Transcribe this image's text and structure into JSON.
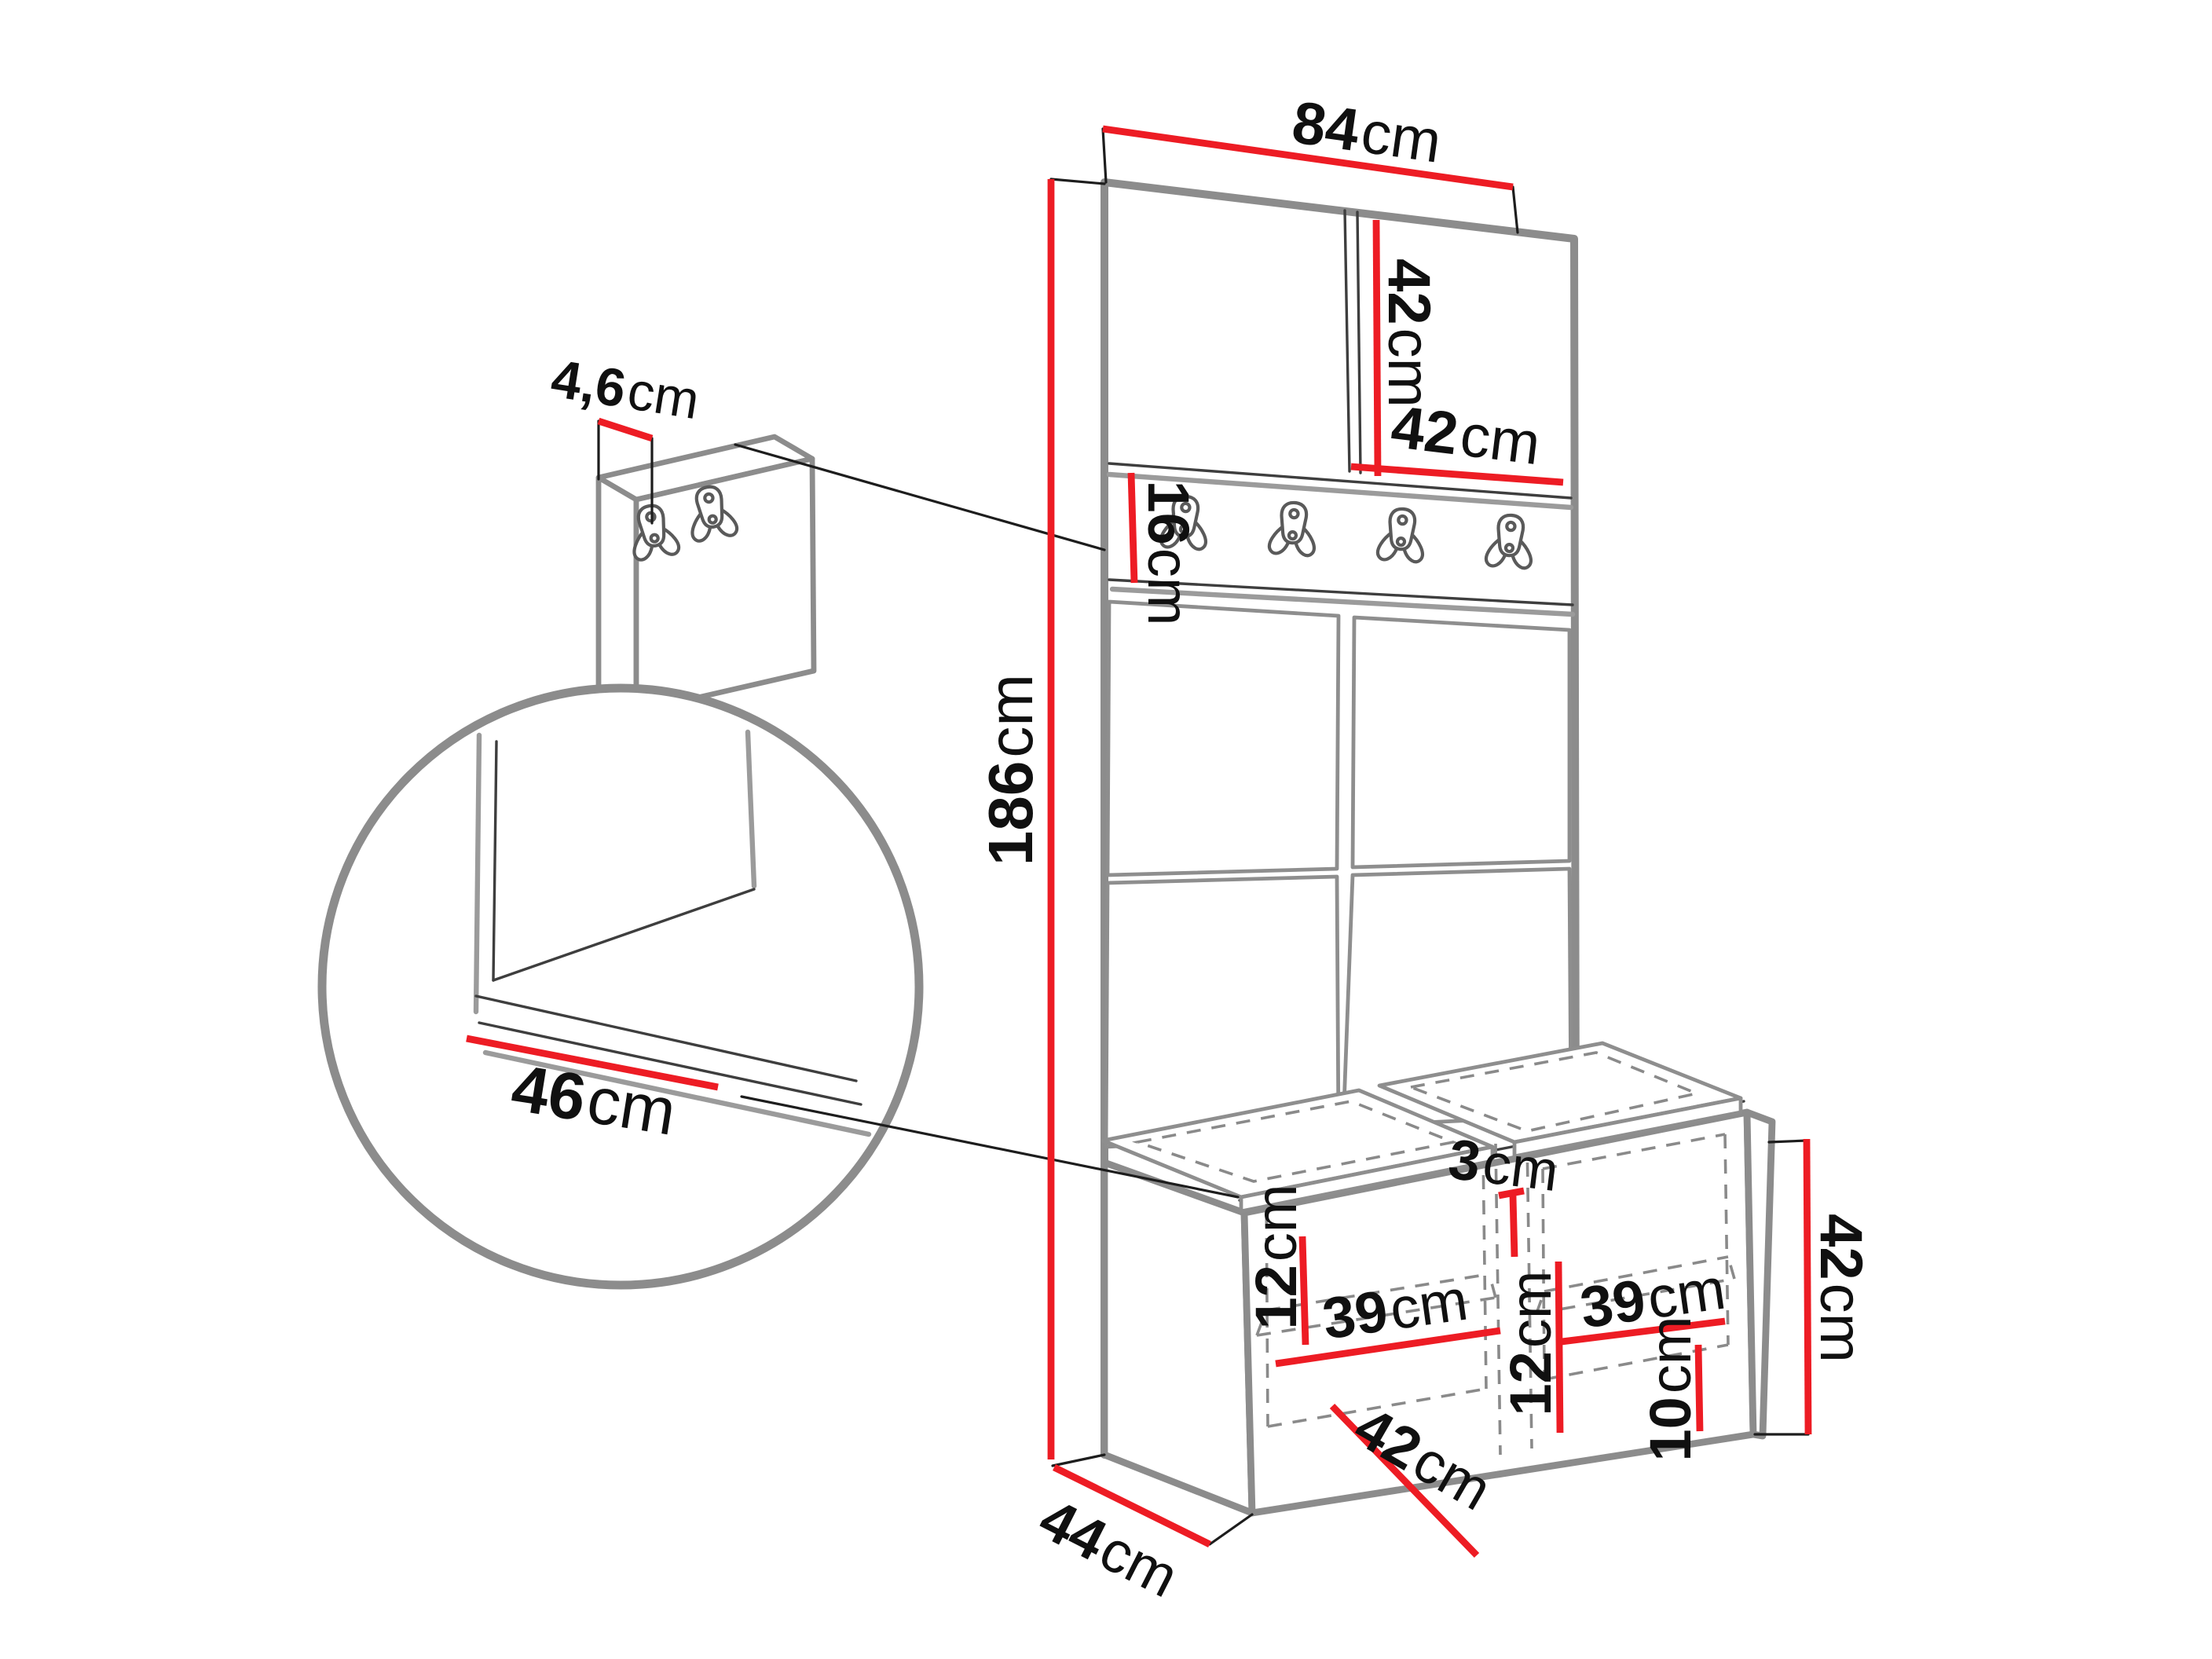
{
  "diagram": {
    "title": "hallway-furniture-dimension-drawing",
    "background": "#ffffff",
    "colors": {
      "dimension_red": "#ed1c24",
      "outline_gray": "#8c8c8c",
      "line_dark": "#3e3e3e",
      "dashed_gray": "#8a8a8a",
      "text_black": "#101010"
    },
    "dimensions": {
      "top_width": {
        "value": "84",
        "unit": "cm"
      },
      "cabinet_height": {
        "value": "42",
        "unit": "cm"
      },
      "cabinet_width": {
        "value": "42",
        "unit": "cm"
      },
      "hook_rail_height": {
        "value": "16",
        "unit": "cm"
      },
      "total_height": {
        "value": "186",
        "unit": "cm"
      },
      "wall_panel_thickness": {
        "value": "4,6",
        "unit": "cm"
      },
      "seat_depth_detail": {
        "value": "46",
        "unit": "cm"
      },
      "cushion_gap": {
        "value": "3",
        "unit": "cm"
      },
      "left_upper_height": {
        "value": "12",
        "unit": "cm"
      },
      "left_compartment_width": {
        "value": "39",
        "unit": "cm"
      },
      "right_upper_height": {
        "value": "12",
        "unit": "cm"
      },
      "right_compartment_width": {
        "value": "39",
        "unit": "cm"
      },
      "compartment_depth": {
        "value": "42",
        "unit": "cm"
      },
      "lower_section_height": {
        "value": "10",
        "unit": "cm"
      },
      "bench_height": {
        "value": "42",
        "unit": "cm"
      },
      "bench_depth": {
        "value": "44",
        "unit": "cm"
      }
    }
  }
}
